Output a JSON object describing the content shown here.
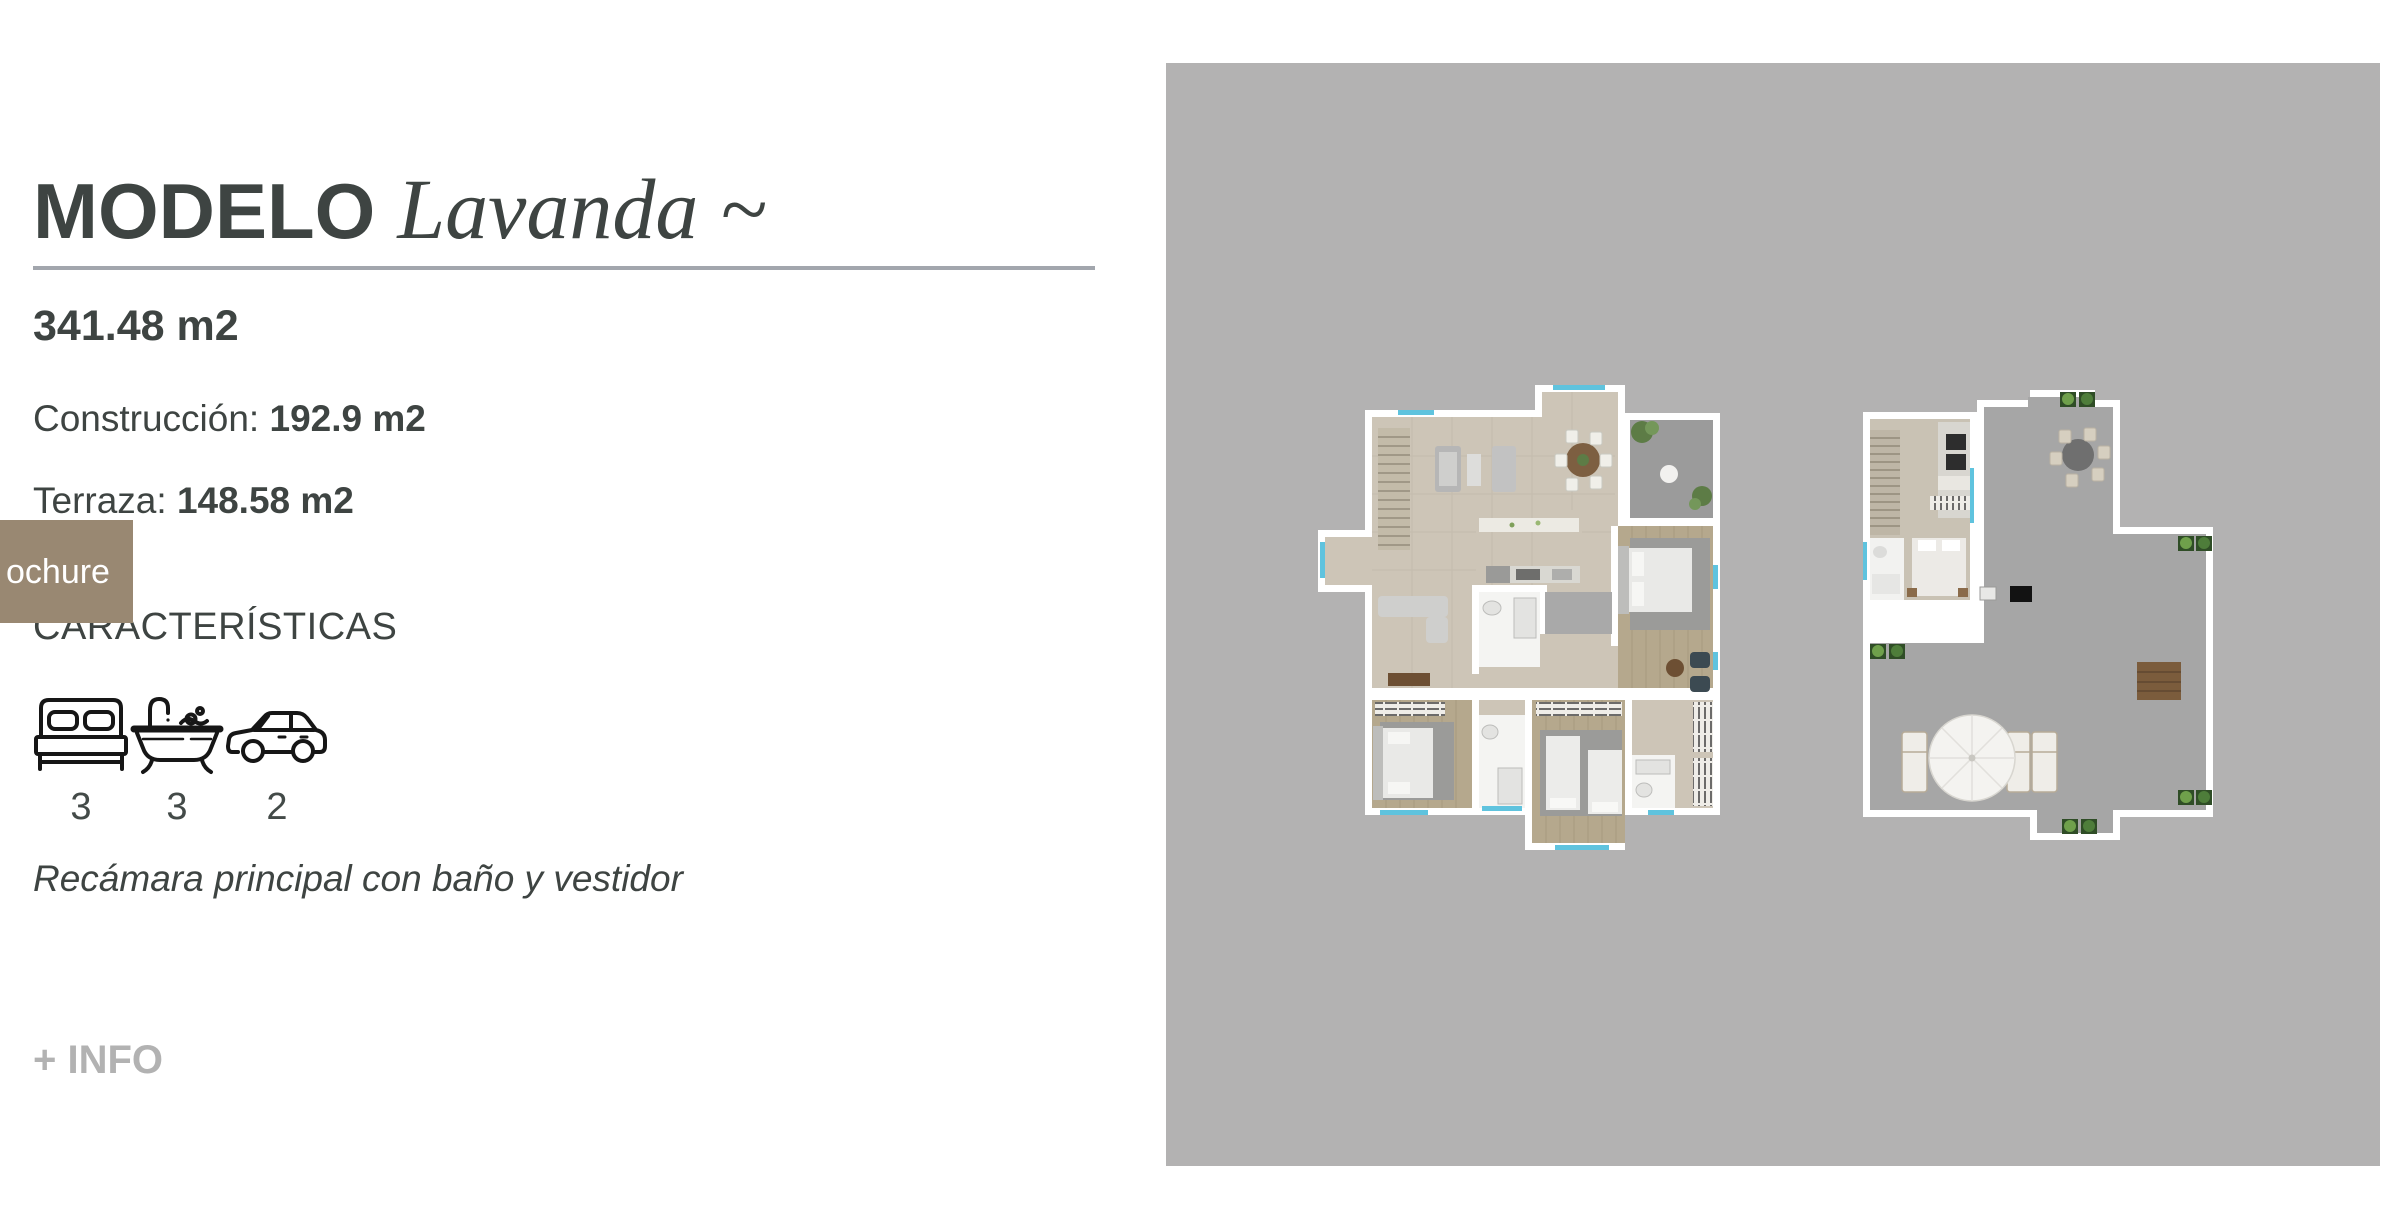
{
  "header": {
    "model_label": "MODELO",
    "model_name": "Lavanda ~"
  },
  "specs": {
    "total_area": "341.48 m2",
    "construction": {
      "label": "Construcción:",
      "value": "192.9 m2"
    },
    "terrace": {
      "label": "Terraza:",
      "value": "148.58 m2"
    }
  },
  "brochure": {
    "visible_label": "ochure",
    "background": "#998872",
    "text_color": "#ffffff"
  },
  "features": {
    "heading": "CARACTERÍSTICAS",
    "items": [
      {
        "name": "bedrooms",
        "icon": "bed-icon",
        "count": "3"
      },
      {
        "name": "bathrooms",
        "icon": "bathtub-icon",
        "count": "3"
      },
      {
        "name": "parking",
        "icon": "car-icon",
        "count": "2"
      }
    ],
    "note": "Recámara principal con baño y vestidor"
  },
  "more_info": {
    "label": "+ INFO",
    "color": "#b2b2b2"
  },
  "colors": {
    "text_dark": "#3e4442",
    "divider": "#a2a6ad",
    "panel_background": "#b3b2b2",
    "plan_floor_beige": "#cdc5b7",
    "plan_floor_wood": "#b5a88d",
    "plan_terrace_gray": "#9b9b9b",
    "plan_window_blue": "#5fc3de"
  },
  "floor_plans": {
    "images": [
      "ground-floor-plan",
      "roof-terrace-plan"
    ]
  }
}
